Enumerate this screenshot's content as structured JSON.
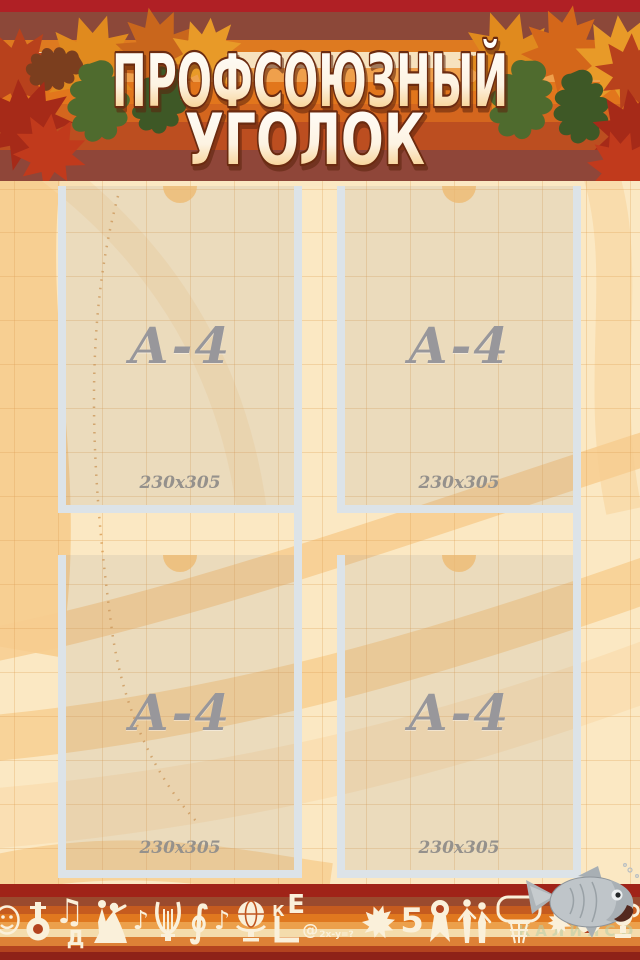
{
  "header": {
    "title_line1": "ПРОФСОЮЗНЫЙ",
    "title_line2": "УГОЛОК"
  },
  "pockets": [
    {
      "label": "А-4",
      "size": "230x305"
    },
    {
      "label": "А-4",
      "size": "230x305"
    },
    {
      "label": "А-4",
      "size": "230x305"
    },
    {
      "label": "А-4",
      "size": "230x305"
    }
  ],
  "bottom_band": {
    "note_double": "♫",
    "note_single": "♪",
    "letter_d": "Д",
    "letter_k": "К",
    "letter_e": "Е",
    "at_sign": "@",
    "formula": "2x-y=?",
    "number_five": "5",
    "clef": "∮",
    "pencil": "✎",
    "icons": [
      "theater-masks",
      "tuba",
      "music-notes",
      "waltz-couple",
      "lyre",
      "treble-clef",
      "globe",
      "school-easel",
      "maple-leaf",
      "award-ribbon",
      "dancers",
      "basketball-hoop",
      "autumn-leaf",
      "soccer-ball",
      "trophy",
      "pencil"
    ]
  },
  "watermark": {
    "text": "КАЛИПСО"
  },
  "colors": {
    "accent_orange": "#DE7A20",
    "dark_red": "#B02025",
    "maroon": "#8C4839",
    "cream_background": "#FBE8C3",
    "pocket_frame": "#DCE3E8",
    "label_gray": "#98979B"
  }
}
